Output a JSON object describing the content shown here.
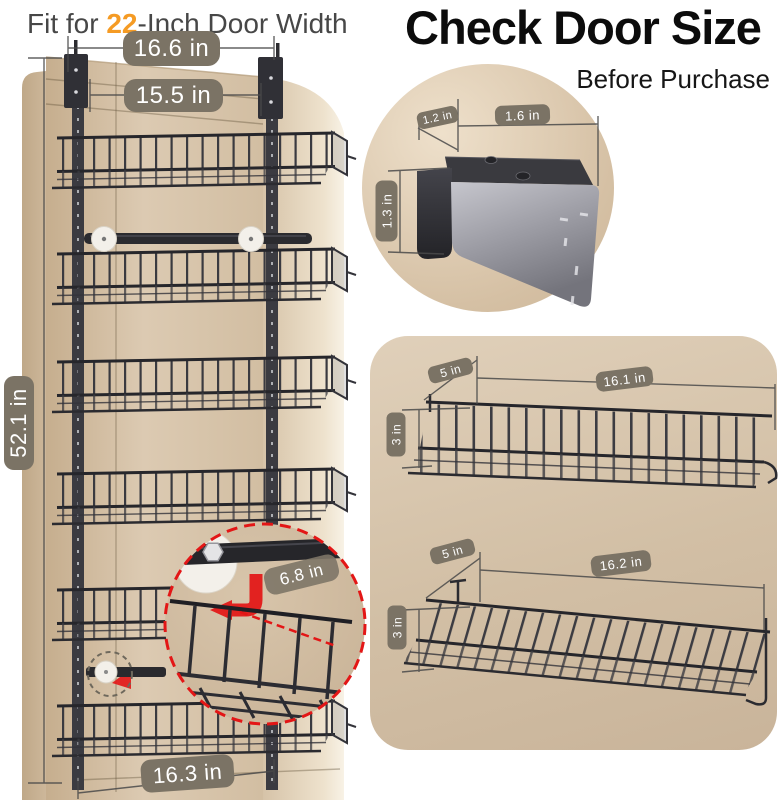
{
  "header": {
    "fit_prefix": "Fit for ",
    "fit_number": "22",
    "fit_suffix": "-Inch Door Width",
    "title": "Check Door Size",
    "subtitle": "Before Purchase"
  },
  "door_diagram": {
    "top_width_label": "16.6 in",
    "inner_width_label": "15.5 in",
    "height_label": "52.1 in",
    "bottom_width_label": "16.3 in",
    "zoom_depth_label": "6.8 in"
  },
  "bracket_diagram": {
    "depth_label": "1.2 in",
    "width_label": "1.6 in",
    "height_label": "1.3 in"
  },
  "top_basket_diagram": {
    "depth_label": "5 in",
    "width_label": "16.1 in",
    "height_label": "3 in"
  },
  "bottom_basket_diagram": {
    "depth_label": "5 in",
    "width_label": "16.2 in",
    "height_label": "3 in"
  },
  "colors": {
    "accent_orange": "#f59b24",
    "measure_red": "#e31616",
    "pill_bg": "#7b7365",
    "door_tan": "#d5c2a7",
    "panel_tan": "#d9c8b1",
    "metal_dark": "#3a3a40"
  }
}
